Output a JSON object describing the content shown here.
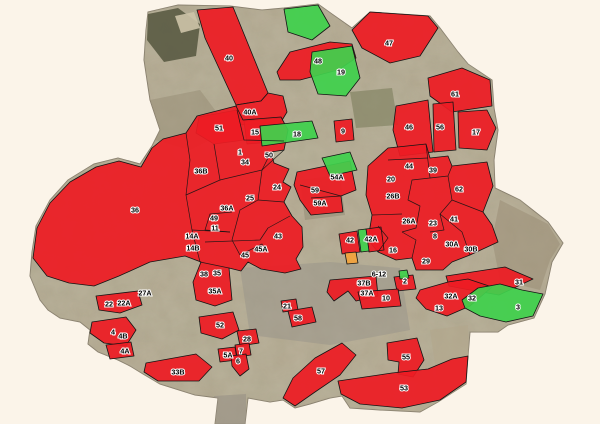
{
  "app": {
    "description": "municipal zoning parcels over aerial basemap"
  },
  "colors": {
    "red": "#ed1c24",
    "green": "#3fd14c",
    "orange": "#f2a33c",
    "zone_outline": "#141414",
    "label_text": "#000000",
    "label_halo": "#ffffff",
    "background": "#fbf4e9",
    "land": "#b0a48d",
    "land_outline": "#847a69"
  },
  "map": {
    "land_outline_points": "148,12 178,5 230,6 262,10 284,8 318,4 332,14 352,28 370,12 430,16 440,28 458,52 468,64 492,80 494,108 498,130 494,160 495,188 520,200 548,222 563,243 552,262 545,294 534,318 508,325 498,332 470,332 468,356 466,384 438,402 420,412 380,410 350,408 342,396 330,398 310,404 295,408 283,400 270,402 248,398 245,424 215,424 218,398 195,395 160,384 143,374 130,366 118,360 98,352 88,344 90,330 80,322 60,318 48,310 40,300 30,276 32,252 36,226 50,200 68,180 94,164 118,158 140,164 152,146 160,130 150,100 144,60 146,30",
    "texture_patches": [
      {
        "p": "148,14 178,8 200,24 196,56 164,62 147,40",
        "f": "#55563e",
        "o": 0.85
      },
      {
        "p": "175,16 194,12 200,28 181,33",
        "f": "#cdc3a8",
        "o": 0.9
      },
      {
        "p": "350,92 392,88 398,125 356,128",
        "f": "#7b7d5c",
        "o": 0.6
      },
      {
        "p": "240,268 330,262 400,268 410,330 330,345 250,335",
        "f": "#98938a",
        "o": 0.5
      },
      {
        "p": "430,330 468,325 470,395 440,398",
        "f": "#b3a78c",
        "o": 0.6
      },
      {
        "p": "300,180 340,175 345,215 305,220",
        "f": "#8f8872",
        "o": 0.5
      },
      {
        "p": "150,100 200,90 230,130 190,150 155,140",
        "f": "#958b74",
        "o": 0.5
      },
      {
        "p": "500,200 548,224 560,244 550,260 540,290 500,280 492,240",
        "f": "#9a8e76",
        "o": 0.55
      },
      {
        "p": "214,396 246,394 246,424 216,424",
        "f": "#9b9488",
        "o": 0.7
      }
    ],
    "regions": [
      {
        "n": "zone-40",
        "c": "red",
        "p": "197,10 233,7 268,93 261,101 236,105 205,38"
      },
      {
        "n": "zone-40A",
        "c": "red",
        "p": "236,105 261,101 268,93 283,96 287,112 281,122 240,125"
      },
      {
        "n": "zone-51",
        "c": "red",
        "p": "199,117 237,110 244,140 214,144 196,133"
      },
      {
        "n": "zone-15",
        "c": "red",
        "p": "244,121 280,118 284,141 247,144"
      },
      {
        "n": "zone-9",
        "c": "red",
        "p": "334,121 352,119 354,140 336,142"
      },
      {
        "n": "zone-47",
        "c": "red",
        "p": "352,30 370,12 428,16 438,28 420,56 390,63 362,48"
      },
      {
        "n": "zone-48",
        "c": "red",
        "p": "277,72 290,52 330,42 352,44 356,58 338,70 300,80 280,80"
      },
      {
        "n": "zone-61",
        "c": "red",
        "p": "428,78 462,68 490,80 492,106 452,112 430,96"
      },
      {
        "n": "zone-46",
        "c": "red",
        "p": "396,106 428,100 433,152 400,156 393,130"
      },
      {
        "n": "zone-56",
        "c": "red",
        "p": "433,104 453,102 456,150 434,152"
      },
      {
        "n": "zone-17",
        "c": "red",
        "p": "458,112 487,110 496,128 487,150 459,148"
      },
      {
        "n": "zones-west-central-cluster",
        "c": "red",
        "p": "33,258 37,228 50,203 70,182 96,167 119,161 141,167 152,148 163,139 186,133 197,116 236,106 243,120 281,117 288,130 284,150 271,152 274,163 289,169 283,182 291,187 284,202 292,216 302,227 303,247 296,259 301,269 285,273 261,269 248,262 241,271 229,268 232,300 215,306 196,300 193,282 201,262 185,256 150,262 119,276 94,286 69,283 47,276"
      },
      {
        "n": "zones-northeast-cluster",
        "c": "red",
        "p": "368,166 388,148 426,144 430,158 448,156 452,166 487,162 493,186 483,212 492,225 498,242 470,255 452,262 443,270 416,270 412,258 396,260 378,252 368,240 372,215 366,195"
      },
      {
        "n": "zones-54A-59-cluster",
        "c": "red",
        "p": "297,172 350,161 356,190 341,196 343,212 311,215 300,200 294,185"
      },
      {
        "n": "zone-42",
        "c": "red",
        "p": "339,234 357,231 360,252 342,254"
      },
      {
        "n": "zone-42A",
        "c": "red",
        "p": "366,229 381,227 384,250 369,252"
      },
      {
        "n": "zone-2",
        "c": "red",
        "p": "394,277 413,275 416,289 397,291"
      },
      {
        "n": "zone-37",
        "c": "red",
        "p": "330,280 376,276 378,296 356,301 348,291 334,301 327,292"
      },
      {
        "n": "zone-10",
        "c": "red",
        "p": "358,292 398,289 401,306 362,309"
      },
      {
        "n": "zone-31",
        "c": "red",
        "p": "446,276 505,267 533,279 499,295 470,290 449,286"
      },
      {
        "n": "zone-32",
        "c": "red",
        "p": "420,290 448,282 468,279 492,287 470,306 447,316 426,309 416,298"
      },
      {
        "n": "zone-21",
        "c": "red",
        "p": "281,301 296,299 298,310 283,312"
      },
      {
        "n": "zone-58",
        "c": "red",
        "p": "288,311 312,307 316,322 292,327"
      },
      {
        "n": "zone-52",
        "c": "red",
        "p": "199,317 233,312 239,330 222,339 201,333"
      },
      {
        "n": "zone-28",
        "c": "red",
        "p": "237,331 256,329 259,343 240,346"
      },
      {
        "n": "zone-7",
        "c": "red",
        "p": "235,345 249,343 251,355 237,357"
      },
      {
        "n": "zone-5A",
        "c": "red",
        "p": "218,349 235,347 237,360 220,362"
      },
      {
        "n": "zone-6",
        "c": "red",
        "p": "231,356 246,354 249,369 240,376 232,366"
      },
      {
        "n": "zone-4",
        "c": "red",
        "p": "92,322 126,317 136,330 126,346 104,343 90,333"
      },
      {
        "n": "zone-4A",
        "c": "red",
        "p": "106,345 131,342 134,356 110,359"
      },
      {
        "n": "zone-22",
        "c": "red",
        "p": "96,296 138,291 142,305 120,313 99,310"
      },
      {
        "n": "zone-33B",
        "c": "red",
        "p": "146,363 196,354 212,367 199,381 158,381 144,372"
      },
      {
        "n": "zone-57",
        "c": "red",
        "p": "342,343 356,355 340,375 315,392 295,406 283,398 293,378 315,358"
      },
      {
        "n": "zone-55",
        "c": "red",
        "p": "387,343 417,338 424,360 413,377 398,374 399,362 388,360"
      },
      {
        "n": "zone-53",
        "c": "red",
        "p": "338,381 392,373 428,369 452,359 468,356 466,382 440,400 402,408 360,404 341,394"
      },
      {
        "n": "green-area-north",
        "c": "green",
        "p": "284,9 318,5 330,26 312,40 288,32"
      },
      {
        "n": "zone-19",
        "c": "green",
        "p": "312,52 352,46 360,78 346,96 318,94 310,72"
      },
      {
        "n": "zone-18",
        "c": "green",
        "p": "260,126 312,121 318,138 262,146"
      },
      {
        "n": "green-area-center",
        "c": "green",
        "p": "322,158 350,152 357,170 330,176"
      },
      {
        "n": "green-strip-42",
        "c": "green",
        "p": "358,230 366,229 369,251 361,252"
      },
      {
        "n": "green-dot-2",
        "c": "green",
        "p": "399,271 407,270 409,278 400,279"
      },
      {
        "n": "zone-3",
        "c": "green",
        "p": "462,300 478,288 500,284 522,290 543,294 533,316 506,322 480,316 465,308"
      },
      {
        "n": "orange-patch",
        "c": "orange",
        "p": "345,253 356,252 358,263 347,264"
      }
    ],
    "parcel_lines": [
      "237,110 244,140 284,141",
      "214,144 220,180 186,195",
      "220,180 262,170 271,152",
      "186,133 190,160 186,195 192,230 200,262",
      "262,170 258,200 240,210 232,240 240,255",
      "284,150 262,170",
      "258,200 284,202",
      "232,212 210,214 205,230 230,232",
      "192,230 230,232",
      "205,242 260,240 268,228 290,216",
      "240,255 262,244 266,252",
      "200,262 229,268",
      "388,160 428,158",
      "426,144 430,178 412,180 408,200 420,206 416,228 402,232",
      "430,178 448,176 452,166",
      "448,176 452,200 440,214 444,230 430,232",
      "452,200 483,212",
      "440,214 462,232 470,255",
      "372,215 402,214",
      "412,258 416,240 402,232",
      "378,252 388,238 378,226",
      "300,185 341,196",
      "311,198 341,196"
    ],
    "labels": [
      {
        "t": "40",
        "x": 229,
        "y": 58
      },
      {
        "t": "40A",
        "x": 250,
        "y": 112
      },
      {
        "t": "51",
        "x": 219,
        "y": 128
      },
      {
        "t": "15",
        "x": 255,
        "y": 132
      },
      {
        "t": "18",
        "x": 297,
        "y": 134
      },
      {
        "t": "9",
        "x": 343,
        "y": 131
      },
      {
        "t": "47",
        "x": 389,
        "y": 43
      },
      {
        "t": "48",
        "x": 318,
        "y": 61
      },
      {
        "t": "19",
        "x": 341,
        "y": 72
      },
      {
        "t": "61",
        "x": 455,
        "y": 94
      },
      {
        "t": "46",
        "x": 409,
        "y": 127
      },
      {
        "t": "56",
        "x": 440,
        "y": 127
      },
      {
        "t": "17",
        "x": 476,
        "y": 132
      },
      {
        "t": "1",
        "x": 240,
        "y": 152
      },
      {
        "t": "34",
        "x": 245,
        "y": 162
      },
      {
        "t": "50",
        "x": 269,
        "y": 155
      },
      {
        "t": "36B",
        "x": 201,
        "y": 171
      },
      {
        "t": "36",
        "x": 135,
        "y": 210
      },
      {
        "t": "24",
        "x": 277,
        "y": 187
      },
      {
        "t": "25",
        "x": 250,
        "y": 198
      },
      {
        "t": "36A",
        "x": 227,
        "y": 208
      },
      {
        "t": "49",
        "x": 214,
        "y": 218
      },
      {
        "t": "11",
        "x": 215,
        "y": 228
      },
      {
        "t": "14A",
        "x": 192,
        "y": 236
      },
      {
        "t": "14B",
        "x": 193,
        "y": 248
      },
      {
        "t": "43",
        "x": 278,
        "y": 236
      },
      {
        "t": "45A",
        "x": 261,
        "y": 249
      },
      {
        "t": "45",
        "x": 245,
        "y": 255
      },
      {
        "t": "38",
        "x": 204,
        "y": 274
      },
      {
        "t": "35",
        "x": 217,
        "y": 273
      },
      {
        "t": "35A",
        "x": 215,
        "y": 291
      },
      {
        "t": "54A",
        "x": 337,
        "y": 177
      },
      {
        "t": "59",
        "x": 315,
        "y": 190
      },
      {
        "t": "59A",
        "x": 320,
        "y": 203
      },
      {
        "t": "44",
        "x": 409,
        "y": 166
      },
      {
        "t": "39",
        "x": 433,
        "y": 170
      },
      {
        "t": "20",
        "x": 391,
        "y": 179
      },
      {
        "t": "62",
        "x": 459,
        "y": 189
      },
      {
        "t": "26B",
        "x": 393,
        "y": 196
      },
      {
        "t": "26A",
        "x": 409,
        "y": 221
      },
      {
        "t": "41",
        "x": 454,
        "y": 219
      },
      {
        "t": "23",
        "x": 433,
        "y": 223
      },
      {
        "t": "8",
        "x": 435,
        "y": 236
      },
      {
        "t": "30A",
        "x": 452,
        "y": 244
      },
      {
        "t": "30B",
        "x": 471,
        "y": 249
      },
      {
        "t": "16",
        "x": 393,
        "y": 250
      },
      {
        "t": "29",
        "x": 426,
        "y": 261
      },
      {
        "t": "42",
        "x": 350,
        "y": 240
      },
      {
        "t": "42A",
        "x": 371,
        "y": 239
      },
      {
        "t": "6-12",
        "x": 379,
        "y": 274
      },
      {
        "t": "2",
        "x": 405,
        "y": 281
      },
      {
        "t": "37B",
        "x": 364,
        "y": 283
      },
      {
        "t": "37A",
        "x": 367,
        "y": 293
      },
      {
        "t": "10",
        "x": 386,
        "y": 298
      },
      {
        "t": "31",
        "x": 519,
        "y": 282
      },
      {
        "t": "32A",
        "x": 451,
        "y": 296
      },
      {
        "t": "32",
        "x": 472,
        "y": 298
      },
      {
        "t": "13",
        "x": 439,
        "y": 308
      },
      {
        "t": "3",
        "x": 518,
        "y": 307
      },
      {
        "t": "27A",
        "x": 145,
        "y": 293
      },
      {
        "t": "22",
        "x": 109,
        "y": 304
      },
      {
        "t": "22A",
        "x": 124,
        "y": 303
      },
      {
        "t": "21",
        "x": 287,
        "y": 306
      },
      {
        "t": "58",
        "x": 298,
        "y": 318
      },
      {
        "t": "52",
        "x": 220,
        "y": 325
      },
      {
        "t": "28",
        "x": 247,
        "y": 339
      },
      {
        "t": "7",
        "x": 241,
        "y": 351
      },
      {
        "t": "5A",
        "x": 228,
        "y": 355
      },
      {
        "t": "6",
        "x": 238,
        "y": 361
      },
      {
        "t": "4",
        "x": 113,
        "y": 332
      },
      {
        "t": "4B",
        "x": 123,
        "y": 336
      },
      {
        "t": "4A",
        "x": 125,
        "y": 351
      },
      {
        "t": "33B",
        "x": 178,
        "y": 372
      },
      {
        "t": "57",
        "x": 321,
        "y": 371
      },
      {
        "t": "55",
        "x": 406,
        "y": 357
      },
      {
        "t": "53",
        "x": 404,
        "y": 388
      }
    ]
  }
}
